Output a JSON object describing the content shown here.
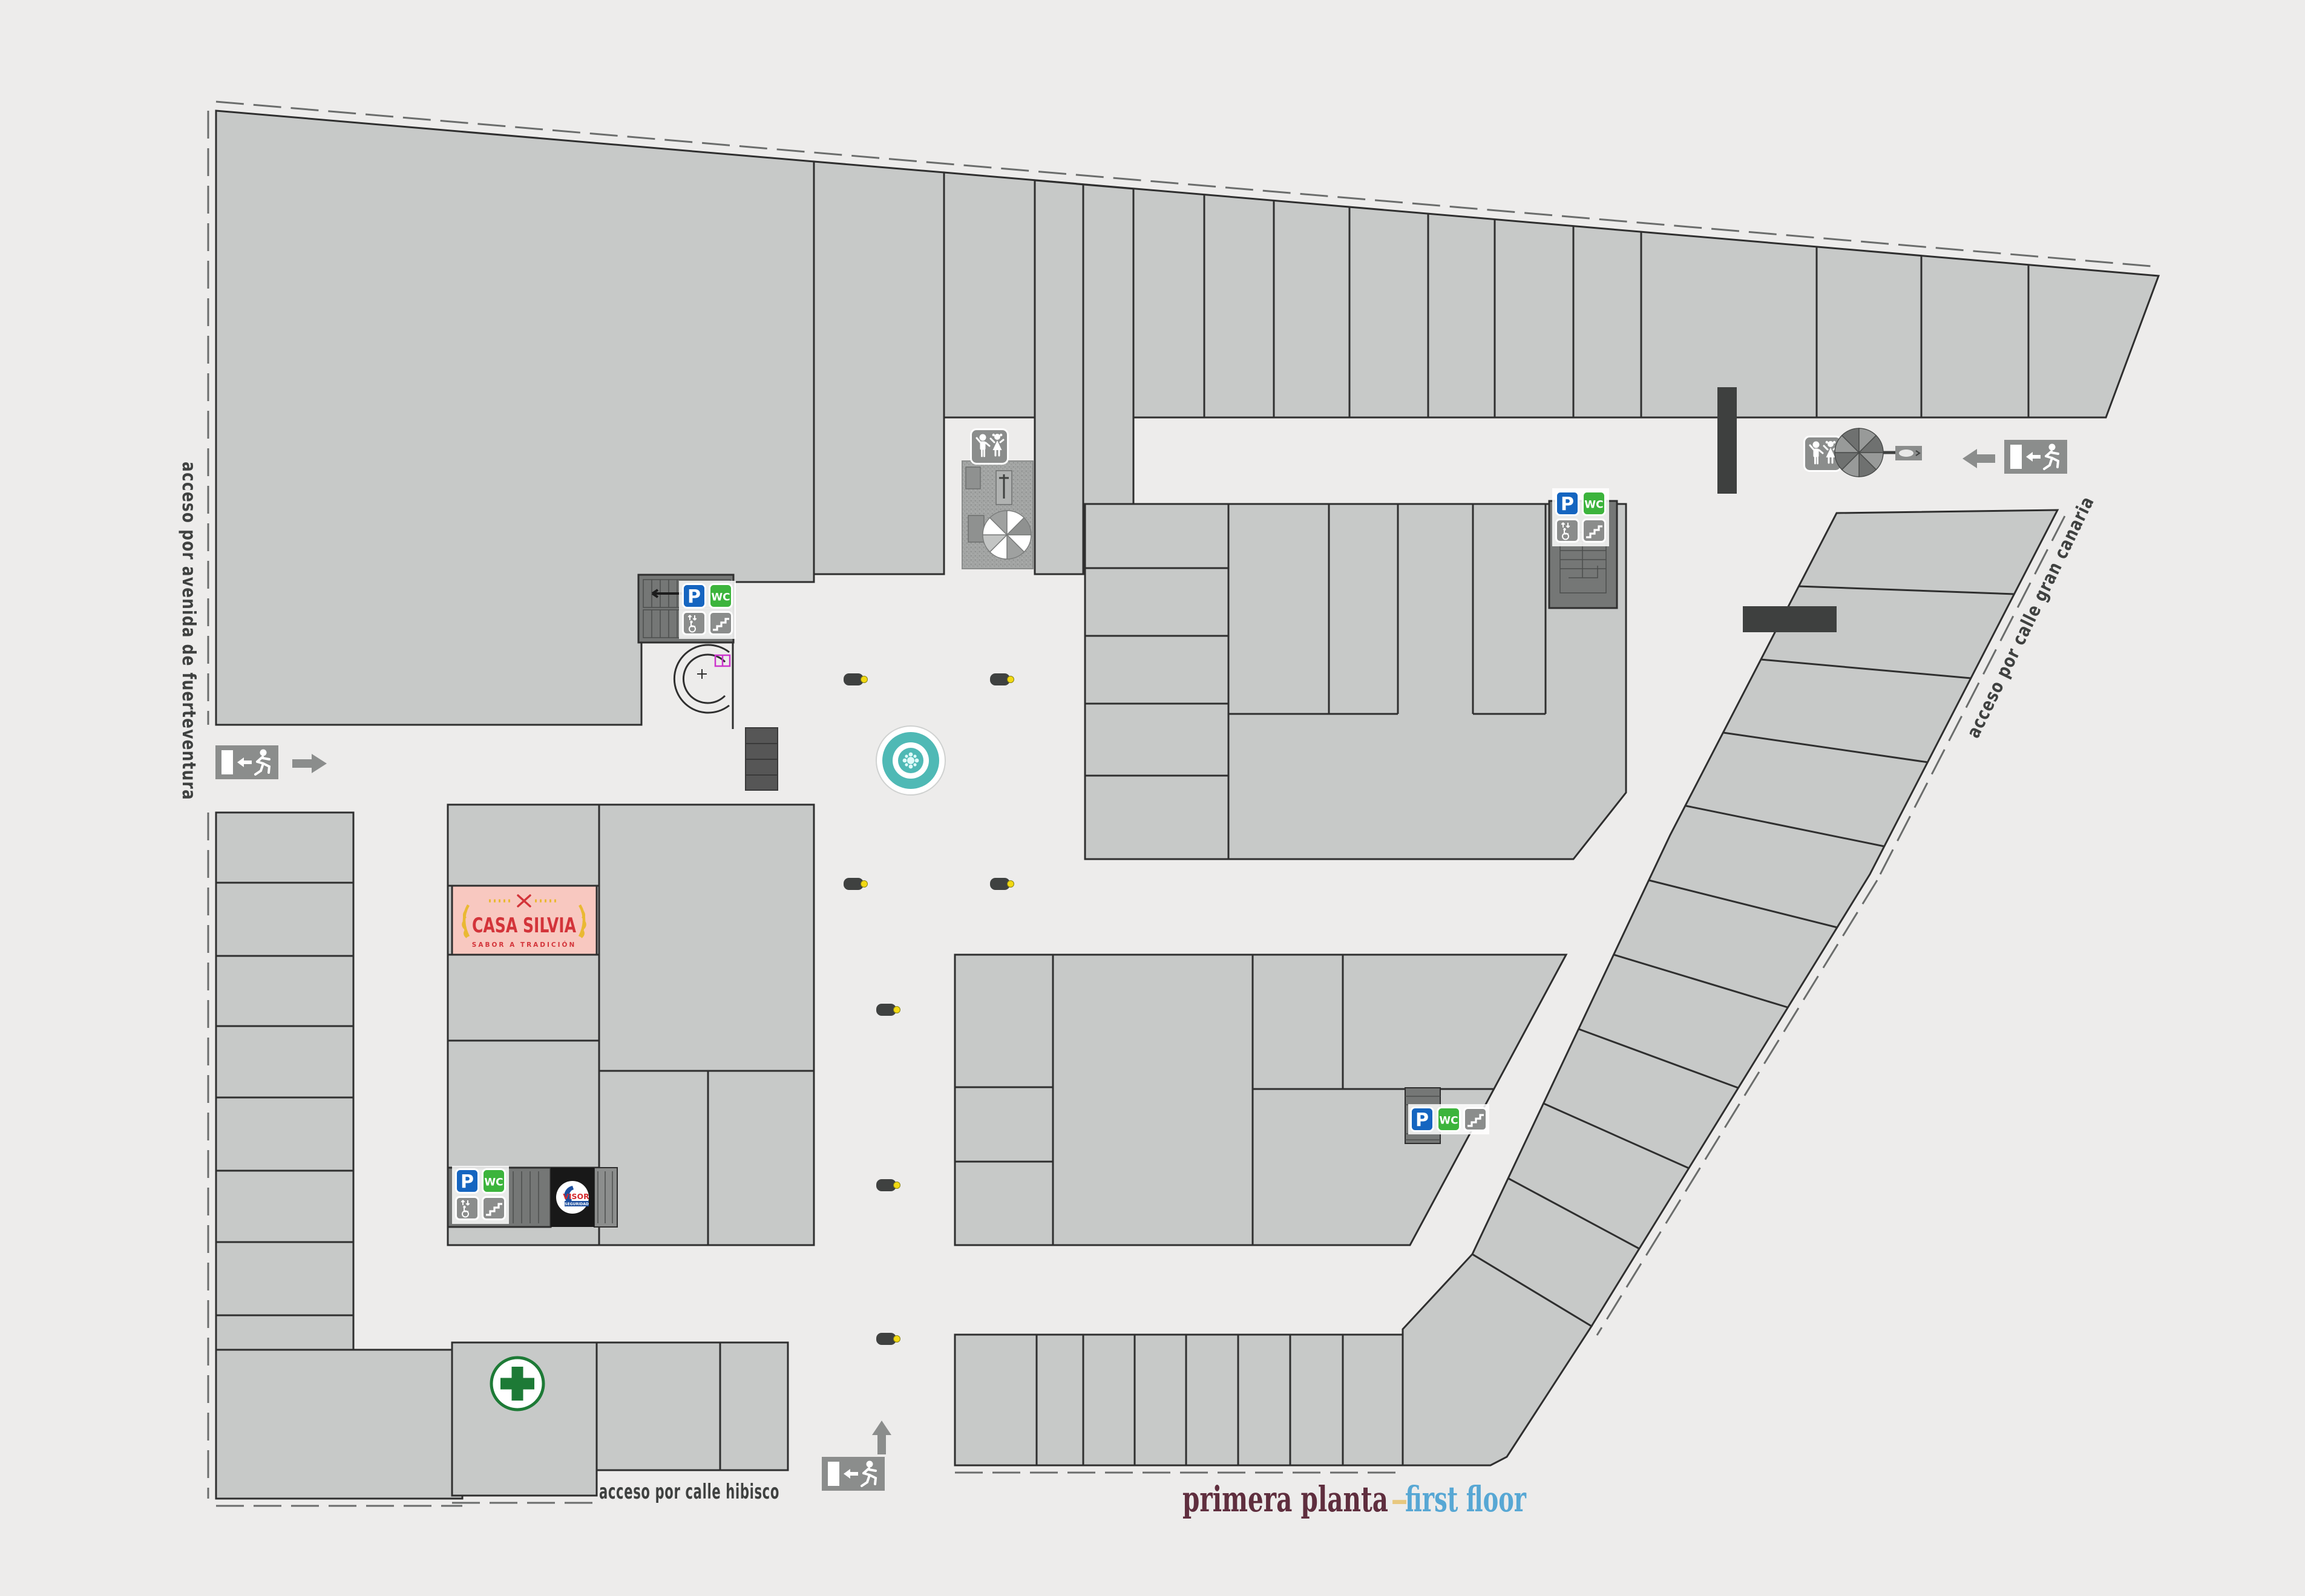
{
  "floor_title": {
    "primary": "primera planta",
    "separator": "–",
    "secondary": "first floor"
  },
  "access_labels": {
    "west": "acceso por avenida de fuerteventura",
    "east": "acceso por calle gran canaria",
    "south": "acceso por calle hibisco"
  },
  "amenity_icons": {
    "parking": "P",
    "toilets": "WC",
    "elevator": "elevator-icon",
    "stairs": "stairs-icon",
    "exit": "emergency-exit-icon",
    "kids_area": "children-area-icon",
    "pharmacy": "green-cross-icon",
    "fountain": "fountain",
    "umbrella": "parasol",
    "bench": "bench-with-lamp"
  },
  "stores": {
    "casa_silvia": {
      "name": "CASA SILVIA",
      "tagline": "SABOR A TRADICIÓN"
    },
    "security": {
      "name": "VISOR",
      "subtitle": "SEGURIDAD"
    }
  },
  "colors": {
    "background": "#edeceb",
    "store_fill": "#c7c9c8",
    "wall": "#2f2f2f",
    "stair_fill": "#757776",
    "dark_corridor": "#3e403f",
    "parking_blue": "#1565c0",
    "wc_green": "#3cb43c",
    "icon_gray": "#8b8d8c",
    "fountain_teal": "#4fb9b5",
    "casa_pink": "#f8c8c0",
    "casa_red": "#d3343a",
    "casa_gold": "#eab933",
    "title_maroon": "#5f2e3e",
    "title_blue": "#57a7d4",
    "title_gold": "#e8c87f",
    "bench_yellow": "#f2d913",
    "pharmacy_green": "#1d7a36",
    "visor_red": "#d42a2e",
    "visor_blue": "#1d4f9e",
    "label_gray": "#3f4140"
  }
}
